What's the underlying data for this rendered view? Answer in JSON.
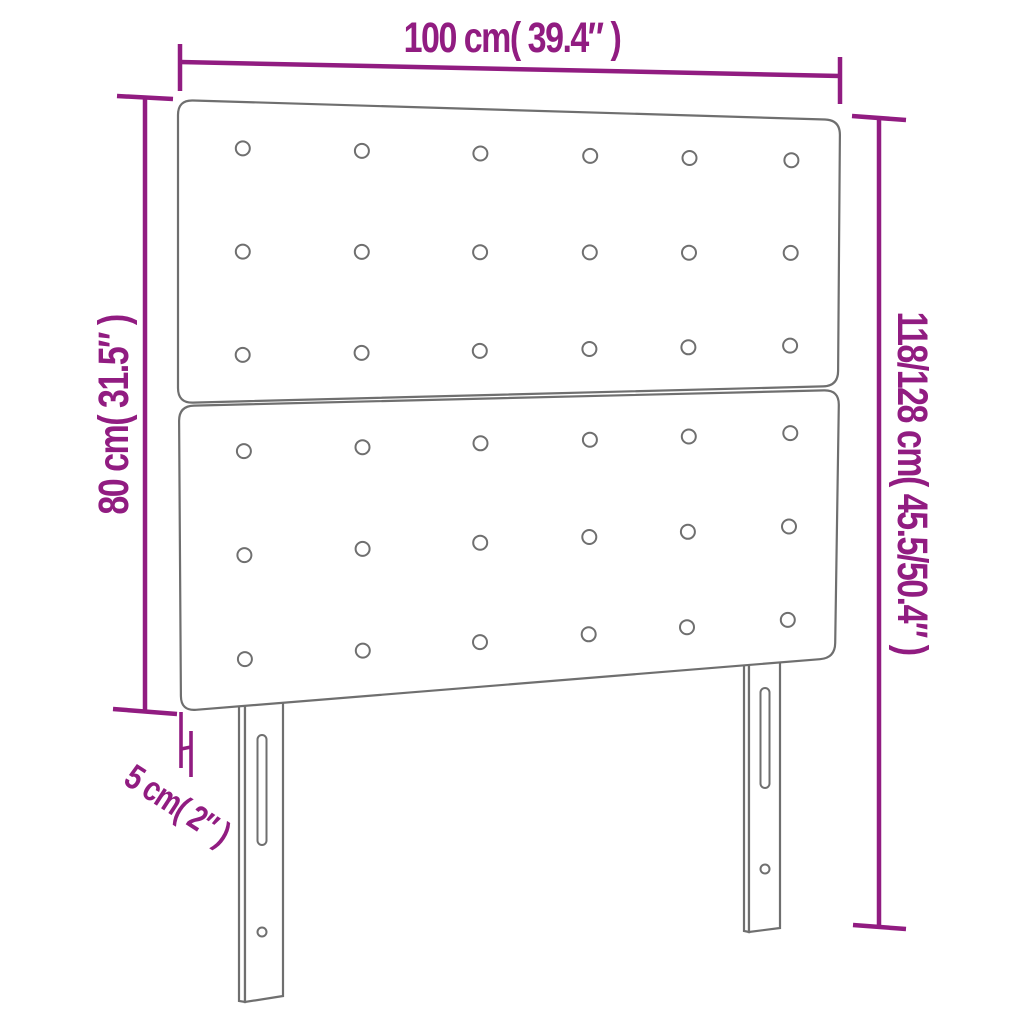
{
  "canvas": {
    "background": "#ffffff"
  },
  "colors": {
    "dimension_accent": "#911c81",
    "product_outline": "#6f6f6f"
  },
  "dimensions": {
    "width": {
      "label": "100 cm( 39.4″ )"
    },
    "board_height": {
      "label": "80 cm( 31.5″ )"
    },
    "total_height": {
      "label": "118/128 cm( 45.5/50.4″ )"
    },
    "leg_depth": {
      "label": "5 cm( 2″ )"
    }
  },
  "headboard": {
    "panels": 2,
    "tufting_buttons": {
      "rows_per_panel": 3,
      "columns": 6,
      "total": 36
    },
    "legs": 2,
    "leg_features": [
      "mounting-slot",
      "screw-hole"
    ]
  }
}
